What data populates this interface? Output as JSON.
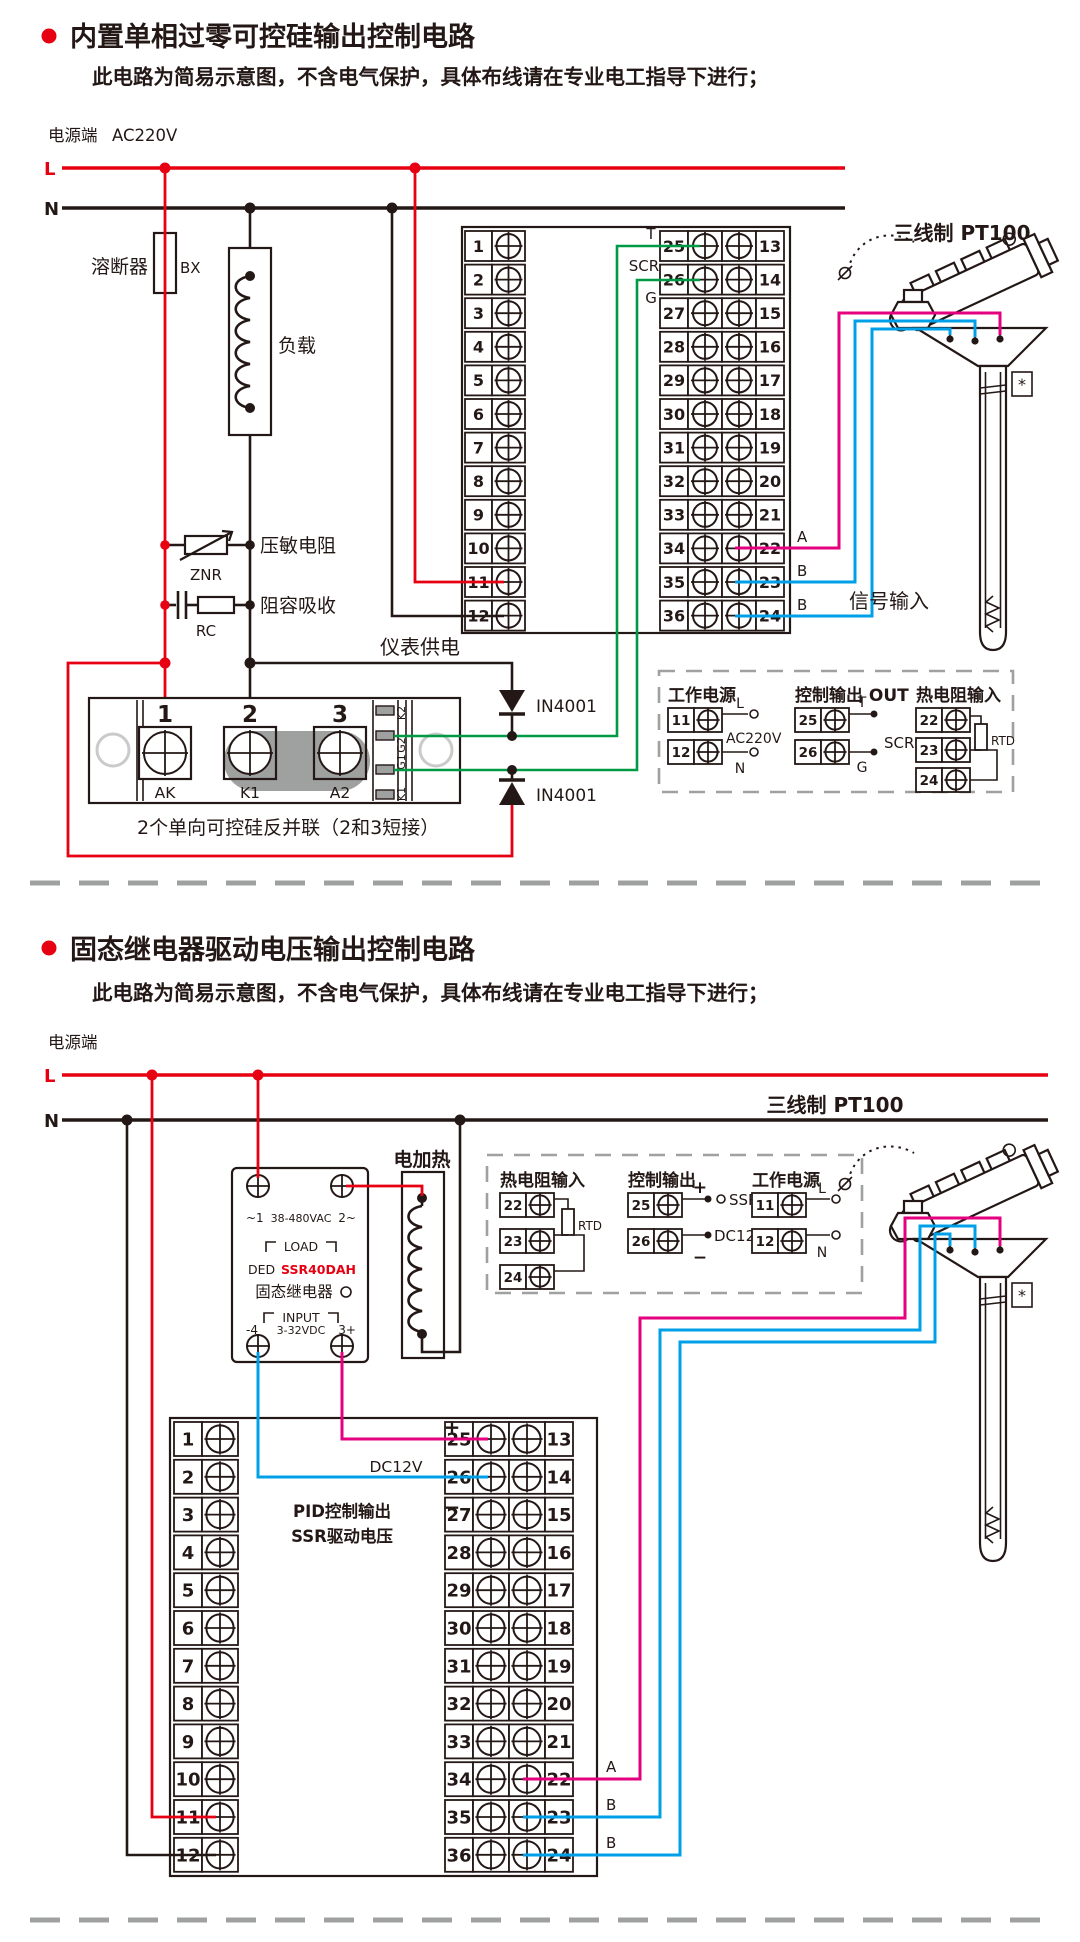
{
  "section1": {
    "title": "内置单相过零可控硅输出控制电路",
    "subtitle": "此电路为简易示意图，不含电气保护，具体布线请在专业电工指导下进行；",
    "power_label": "电源端",
    "power_voltage": "AC220V",
    "l": "L",
    "n": "N",
    "fuse_label": "溶断器",
    "fuse_code": "BX",
    "load_label": "负载",
    "varistor_label": "压敏电阻",
    "varistor_code": "ZNR",
    "rc_label": "阻容吸收",
    "rc_code": "RC",
    "meter_supply": "仪表供电",
    "t_label": "T",
    "scr_label": "SCR",
    "g_label": "G",
    "a_label": "A",
    "b1_label": "B",
    "b2_label": "B",
    "signal_input": "信号输入",
    "pt100_label": "三线制 PT100",
    "pt100_star": "*",
    "diode1": "IN4001",
    "diode2": "IN4001",
    "scr_module": {
      "n1": "1",
      "n2": "2",
      "n3": "3",
      "ak": "AK",
      "k1": "K1",
      "a2": "A2",
      "pad1": "K2",
      "pad2": "G2",
      "pad3": "G1",
      "pad4": "K1",
      "caption": "2个单向可控硅反并联（2和3短接）"
    },
    "terminals_left": [
      "1",
      "2",
      "3",
      "4",
      "5",
      "6",
      "7",
      "8",
      "9",
      "10",
      "11",
      "12"
    ],
    "terminals_mid": [
      "25",
      "26",
      "27",
      "28",
      "29",
      "30",
      "31",
      "32",
      "33",
      "34",
      "35",
      "36"
    ],
    "terminals_right": [
      "13",
      "14",
      "15",
      "16",
      "17",
      "18",
      "19",
      "20",
      "21",
      "22",
      "23",
      "24"
    ],
    "info_box": {
      "power": {
        "title": "工作电源",
        "terminals": [
          "11",
          "12"
        ],
        "l": "L",
        "n": "N",
        "voltage": "AC220V"
      },
      "output": {
        "title": "控制输出 OUT",
        "terminals": [
          "25",
          "26"
        ],
        "t": "T",
        "g": "G",
        "scr": "SCR"
      },
      "rtd": {
        "title": "热电阻输入",
        "terminals": [
          "22",
          "23",
          "24"
        ],
        "rtd": "RTD"
      }
    }
  },
  "section2": {
    "title": "固态继电器驱动电压输出控制电路",
    "subtitle": "此电路为简易示意图，不含电气保护，具体布线请在专业电工指导下进行；",
    "power_label": "电源端",
    "l": "L",
    "n": "N",
    "heater_label": "电加热",
    "ssr": {
      "t1": "~1",
      "tv": "38-480VAC",
      "t2": "2~",
      "load": "LOAD",
      "brand": "DED",
      "model": "SSR40DAH",
      "name": "固态继电器",
      "input": "INPUT",
      "b1": "-4",
      "bv": "3-32VDC",
      "b2": "3+"
    },
    "plus": "+",
    "minus": "−",
    "dc12v": "DC12V",
    "pid_line1": "PID控制输出",
    "pid_line2": "SSR驱动电压",
    "a_label": "A",
    "b1_label": "B",
    "b2_label": "B",
    "pt100_label": "三线制 PT100",
    "terminals_left": [
      "1",
      "2",
      "3",
      "4",
      "5",
      "6",
      "7",
      "8",
      "9",
      "10",
      "11",
      "12"
    ],
    "terminals_mid": [
      "25",
      "26",
      "27",
      "28",
      "29",
      "30",
      "31",
      "32",
      "33",
      "34",
      "35",
      "36"
    ],
    "terminals_right": [
      "13",
      "14",
      "15",
      "16",
      "17",
      "18",
      "19",
      "20",
      "21",
      "22",
      "23",
      "24"
    ],
    "info_box": {
      "rtd": {
        "title": "热电阻输入",
        "terminals": [
          "22",
          "23",
          "24"
        ],
        "rtd": "RTD"
      },
      "output": {
        "title": "控制输出",
        "terminals": [
          "25",
          "26"
        ],
        "plus": "+",
        "minus": "−",
        "ssr": "SSR",
        "dc": "DC12V"
      },
      "power": {
        "title": "工作电源",
        "terminals": [
          "11",
          "12"
        ],
        "l": "L",
        "n": "N"
      }
    }
  }
}
